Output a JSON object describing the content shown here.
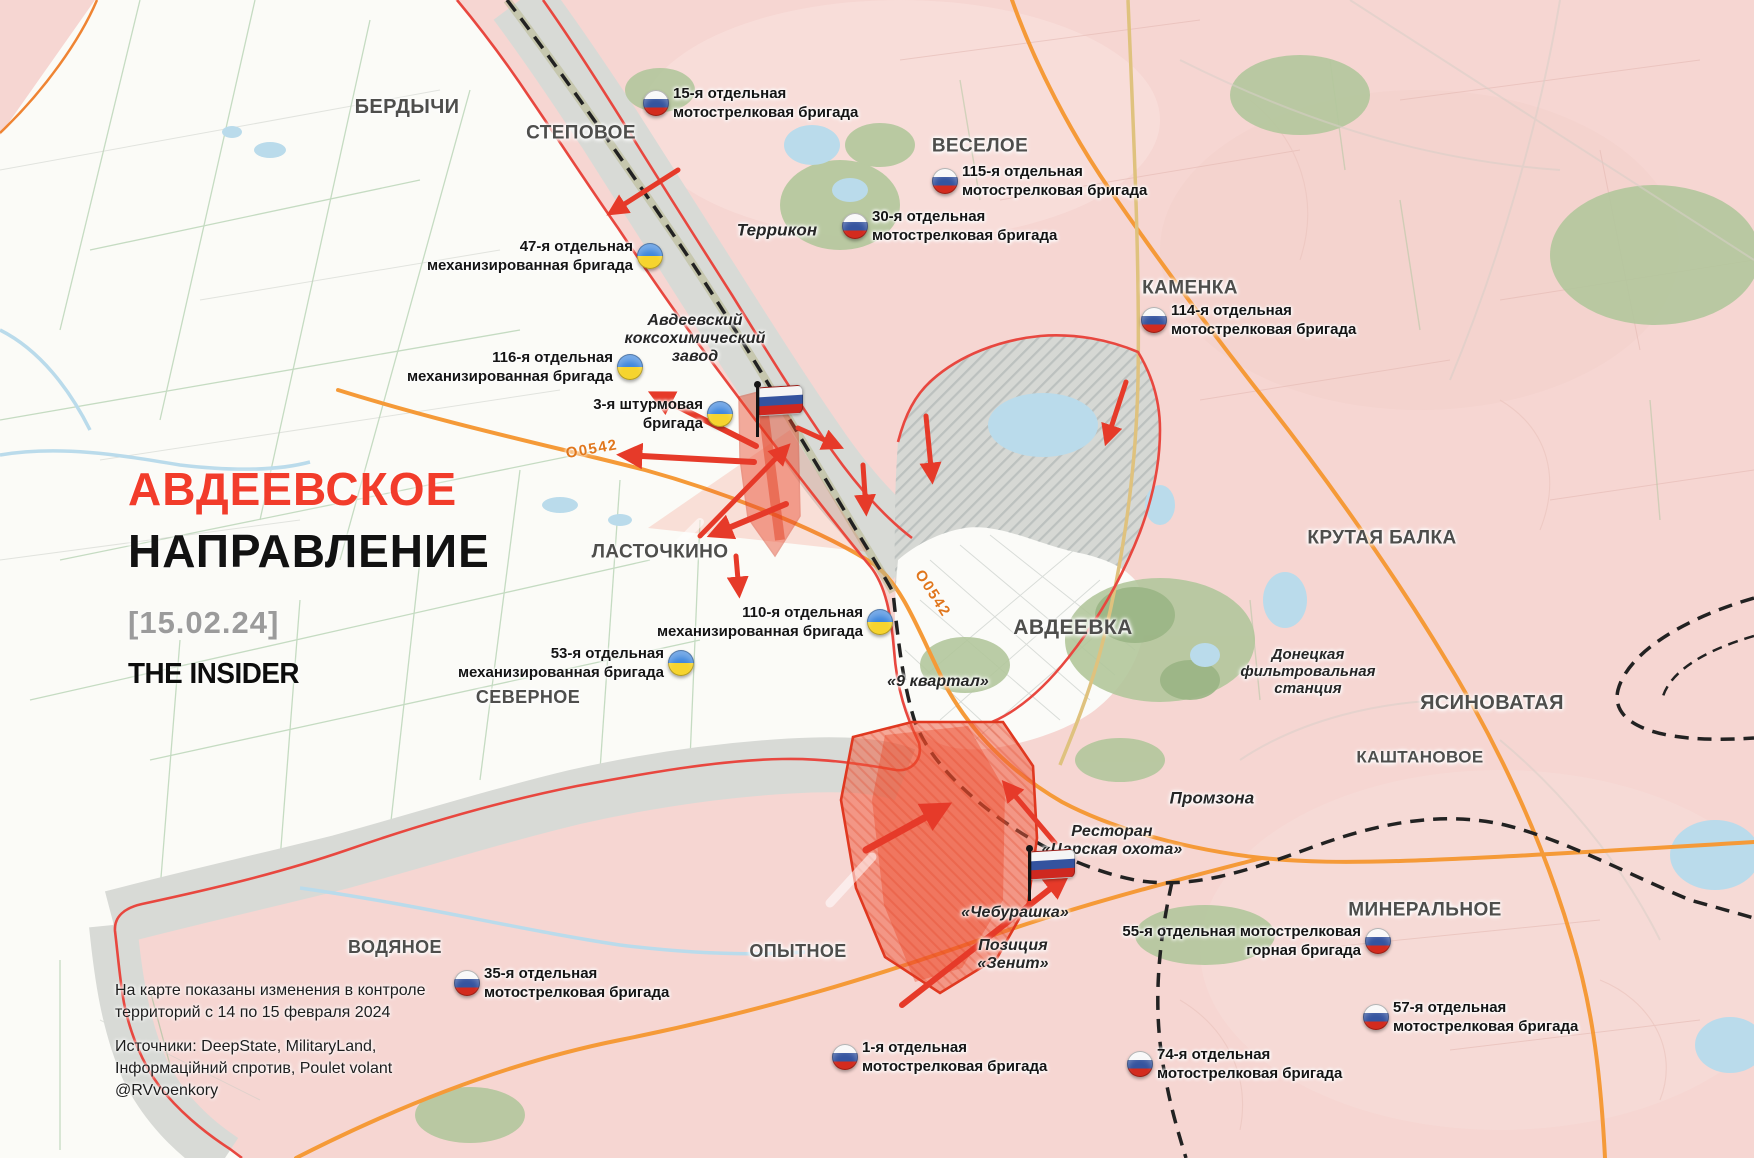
{
  "map": {
    "title": {
      "line1": "АВДЕЕВСКОЕ",
      "line2": "НАПРАВЛЕНИЕ",
      "date": "[15.02.24]",
      "logo": "THE INSIDER"
    },
    "footer": {
      "note_line1": "На карте показаны изменения в контроле",
      "note_line2": "территорий с 14 по 15 февраля 2024",
      "sources_line1": "Источники: DeepState, MilitaryLand,",
      "sources_line2": "Інформаційний спротив, Poulet volant",
      "sources_line3": "@RVvoenkory"
    },
    "colors": {
      "accent_red": "#f23c2b",
      "date_grey": "#9b9b9b",
      "label_grey": "#4e4e4c",
      "ru_controlled_pink": "#f6d6d2",
      "ua_controlled_white": "#fbfbf7",
      "grey_zone": "#d8dad6",
      "captured_red": "#f0512e",
      "front_line_red": "#e8473f",
      "road_orange": "#f59a38",
      "railway_black": "#222222",
      "water_blue": "#badbeb",
      "forest_green": "#b3c79c",
      "ua_flag_blue": "#3f87dd",
      "ua_flag_yellow": "#f6d42e",
      "ru_flag_blue": "#35549f",
      "ru_flag_red": "#d32b1e"
    },
    "places": [
      {
        "id": "berdychi",
        "label": "БЕРДЫЧИ",
        "x": 407,
        "y": 107,
        "size": 20,
        "cls": "city"
      },
      {
        "id": "stepovoe",
        "label": "СТЕПОВОЕ",
        "x": 581,
        "y": 133,
        "size": 19,
        "cls": "city"
      },
      {
        "id": "veseloe",
        "label": "ВЕСЕЛОЕ",
        "x": 980,
        "y": 146,
        "size": 19,
        "cls": "city"
      },
      {
        "id": "terrikon",
        "label": "Террикон",
        "x": 777,
        "y": 230,
        "size": 17,
        "cls": "loc"
      },
      {
        "id": "kamenka",
        "label": "КАМЕНКА",
        "x": 1190,
        "y": 288,
        "size": 19,
        "cls": "city"
      },
      {
        "id": "koksohim",
        "lines": [
          "Авдеевский",
          "коксохимический",
          "завод"
        ],
        "x": 695,
        "y": 339,
        "size": 16,
        "cls": "loc"
      },
      {
        "id": "lastochkino",
        "label": "ЛАСТОЧКИНО",
        "x": 660,
        "y": 552,
        "size": 19,
        "cls": "city"
      },
      {
        "id": "avdeevka",
        "label": "АВДЕЕВКА",
        "x": 1073,
        "y": 628,
        "size": 21,
        "cls": "city"
      },
      {
        "id": "krutaya-balka",
        "label": "КРУТАЯ БАЛКА",
        "x": 1382,
        "y": 538,
        "size": 19,
        "cls": "city"
      },
      {
        "id": "filtr-station",
        "lines": [
          "Донецкая",
          "фильтровальная",
          "станция"
        ],
        "x": 1308,
        "y": 672,
        "size": 15,
        "cls": "loc"
      },
      {
        "id": "yasinovataya",
        "label": "ЯСИНОВАТАЯ",
        "x": 1492,
        "y": 703,
        "size": 20,
        "cls": "city"
      },
      {
        "id": "kashtanovoe",
        "label": "КАШТАНОВОЕ",
        "x": 1420,
        "y": 757,
        "size": 17,
        "cls": "city"
      },
      {
        "id": "severnoe",
        "label": "СЕВЕРНОЕ",
        "x": 528,
        "y": 697,
        "size": 18,
        "cls": "city"
      },
      {
        "id": "promzona",
        "label": "Промзона",
        "x": 1212,
        "y": 798,
        "size": 17,
        "cls": "loc"
      },
      {
        "id": "restoran",
        "lines": [
          "Ресторан",
          "«Царская охота»"
        ],
        "x": 1112,
        "y": 841,
        "size": 16,
        "cls": "loc"
      },
      {
        "id": "9-kvartal",
        "label": "«9 квартал»",
        "x": 938,
        "y": 682,
        "size": 16,
        "cls": "loc"
      },
      {
        "id": "cheburashka",
        "label": "«Чебурашка»",
        "x": 1015,
        "y": 913,
        "size": 16,
        "cls": "loc"
      },
      {
        "id": "zenit",
        "lines": [
          "Позиция",
          "«Зенит»"
        ],
        "x": 1013,
        "y": 955,
        "size": 16,
        "cls": "loc"
      },
      {
        "id": "vodyanoe",
        "label": "ВОДЯНОЕ",
        "x": 395,
        "y": 947,
        "size": 18,
        "cls": "city"
      },
      {
        "id": "opytnoe",
        "label": "ОПЫТНОЕ",
        "x": 798,
        "y": 951,
        "size": 18,
        "cls": "city"
      },
      {
        "id": "mineralnoe",
        "label": "МИНЕРАЛЬНОЕ",
        "x": 1425,
        "y": 910,
        "size": 19,
        "cls": "city"
      },
      {
        "id": "road-o0542-west",
        "label": "О0542",
        "x": 592,
        "y": 450,
        "size": 15,
        "cls": "road",
        "rot": -10
      },
      {
        "id": "road-o0542-avdeevka",
        "label": "О0542",
        "x": 932,
        "y": 594,
        "size": 15,
        "cls": "road",
        "rot": 57
      }
    ],
    "units": [
      {
        "id": "15-omsbr",
        "lines": [
          "15-я отдельная",
          "мотострелковая бригада"
        ],
        "flag": "ru",
        "flag_x": 656,
        "flag_y": 103,
        "side": "right"
      },
      {
        "id": "115-omsbr",
        "lines": [
          "115-я отдельная",
          "мотострелковая бригада"
        ],
        "flag": "ru",
        "flag_x": 945,
        "flag_y": 181,
        "side": "right"
      },
      {
        "id": "30-omsbr",
        "lines": [
          "30-я отдельная",
          "мотострелковая бригада"
        ],
        "flag": "ru",
        "flag_x": 855,
        "flag_y": 226,
        "side": "right"
      },
      {
        "id": "114-omsbr",
        "lines": [
          "114-я отдельная",
          "мотострелковая бригада"
        ],
        "flag": "ru",
        "flag_x": 1154,
        "flag_y": 320,
        "side": "right"
      },
      {
        "id": "47-ombr",
        "lines": [
          "47-я отдельная",
          "механизированная бригада"
        ],
        "flag": "ua",
        "flag_x": 650,
        "flag_y": 256,
        "side": "left"
      },
      {
        "id": "116-ombr",
        "lines": [
          "116-я отдельная",
          "механизированная бригада"
        ],
        "flag": "ua",
        "flag_x": 630,
        "flag_y": 367,
        "side": "left"
      },
      {
        "id": "3-oshbr",
        "lines": [
          "3-я штурмовая",
          "бригада"
        ],
        "flag": "ua",
        "flag_x": 720,
        "flag_y": 414,
        "side": "left"
      },
      {
        "id": "110-ombr",
        "lines": [
          "110-я отдельная",
          "механизированная бригада"
        ],
        "flag": "ua",
        "flag_x": 880,
        "flag_y": 622,
        "side": "left"
      },
      {
        "id": "53-ombr",
        "lines": [
          "53-я отдельная",
          "механизированная бригада"
        ],
        "flag": "ua",
        "flag_x": 681,
        "flag_y": 663,
        "side": "left"
      },
      {
        "id": "35-omsbr",
        "lines": [
          "35-я отдельная",
          "мотострелковая бригада"
        ],
        "flag": "ru",
        "flag_x": 467,
        "flag_y": 983,
        "side": "right"
      },
      {
        "id": "1-omsbr",
        "lines": [
          "1-я отдельная",
          "мотострелковая бригада"
        ],
        "flag": "ru",
        "flag_x": 845,
        "flag_y": 1057,
        "side": "right"
      },
      {
        "id": "74-omsbr",
        "lines": [
          "74-я отдельная",
          "мотострелковая бригада"
        ],
        "flag": "ru",
        "flag_x": 1140,
        "flag_y": 1064,
        "side": "right"
      },
      {
        "id": "57-omsbr",
        "lines": [
          "57-я отдельная",
          "мотострелковая бригада"
        ],
        "flag": "ru",
        "flag_x": 1376,
        "flag_y": 1017,
        "side": "right"
      },
      {
        "id": "55-omsbr",
        "lines": [
          "55-я отдельная мотострелковая",
          "горная бригада"
        ],
        "flag": "ru",
        "flag_x": 1378,
        "flag_y": 941,
        "side": "left"
      }
    ],
    "flagpoles": [
      {
        "id": "koksohim-flag",
        "x": 756,
        "y": 437
      },
      {
        "id": "cheburashka-flag",
        "x": 1028,
        "y": 901
      }
    ]
  }
}
